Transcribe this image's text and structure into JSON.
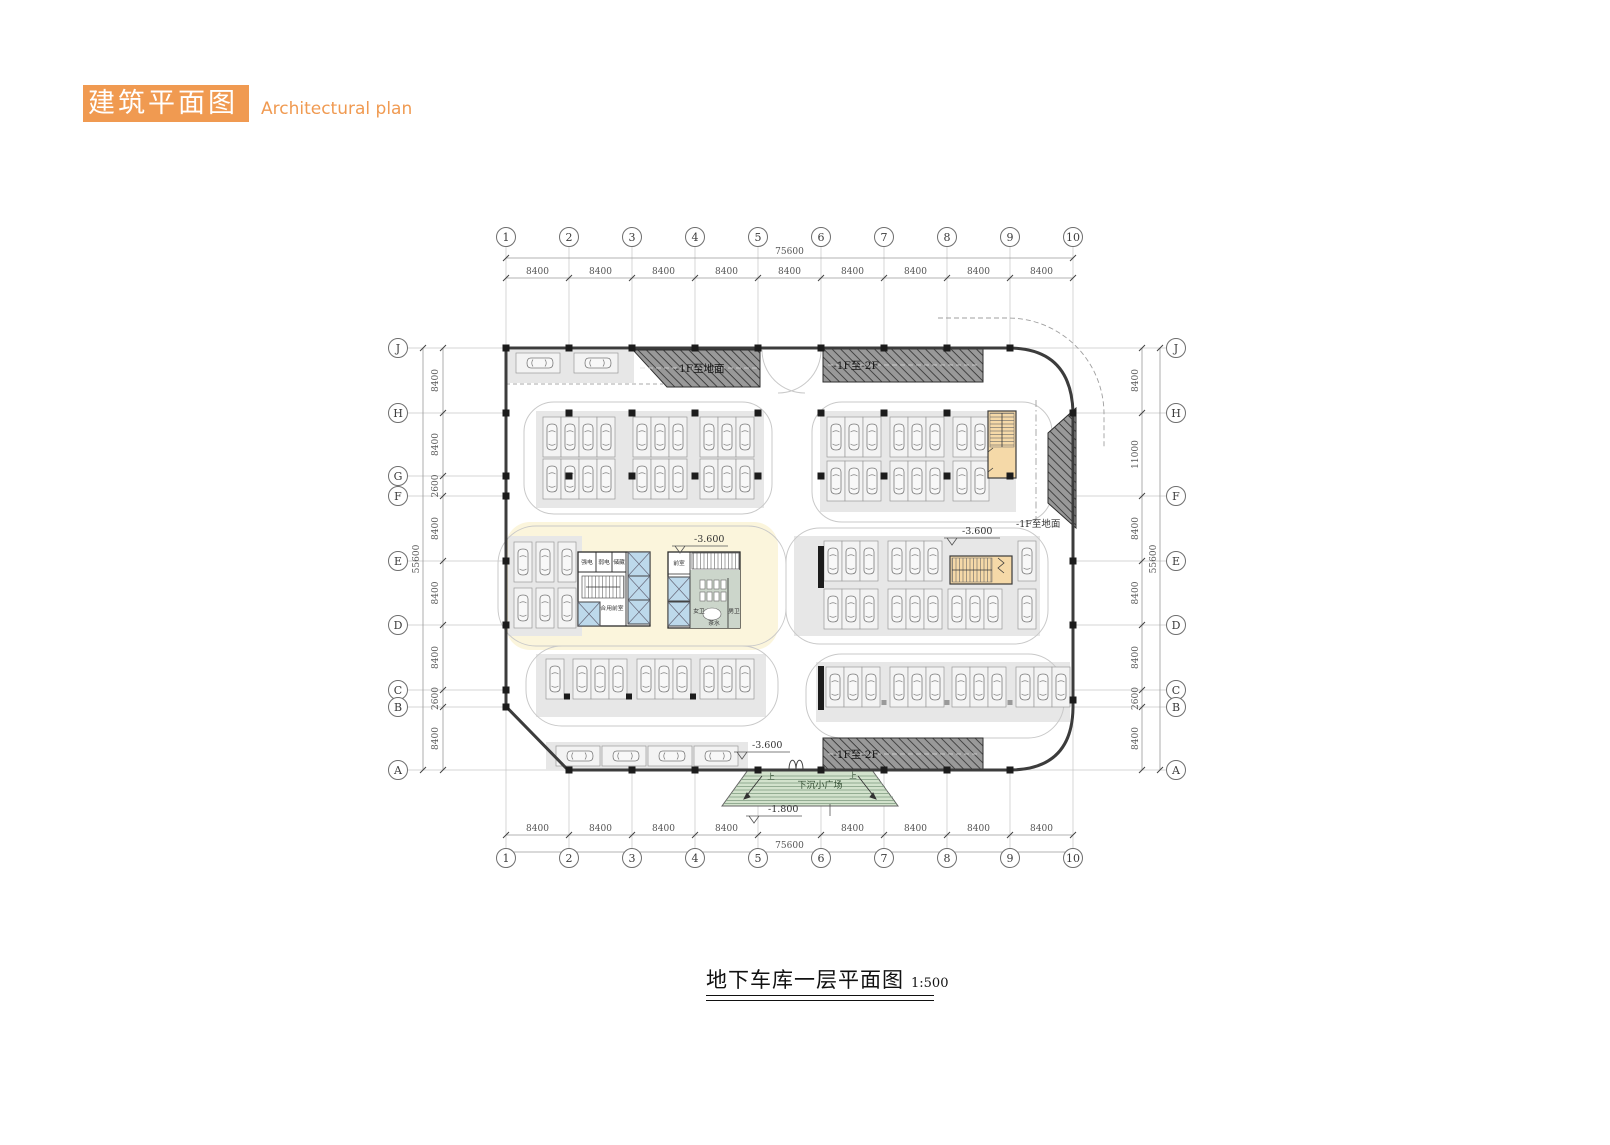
{
  "header": {
    "title_zh": "建筑平面图",
    "title_en": "Architectural plan"
  },
  "caption": {
    "title": "地下车库一层平面图",
    "scale": "1:500"
  },
  "plan": {
    "grid": {
      "top": [
        "1",
        "2",
        "3",
        "4",
        "5",
        "6",
        "7",
        "8",
        "9",
        "10"
      ],
      "bottom": [
        "1",
        "2",
        "3",
        "4",
        "5",
        "6",
        "7",
        "8",
        "9",
        "10"
      ],
      "left": [
        "J",
        "H",
        "G",
        "F",
        "E",
        "D",
        "C",
        "B",
        "A"
      ],
      "right": [
        "J",
        "H",
        "F",
        "E",
        "D",
        "C",
        "B",
        "A"
      ]
    },
    "dims": {
      "top": {
        "total": "75600",
        "segments": [
          "8400",
          "8400",
          "8400",
          "8400",
          "8400",
          "8400",
          "8400",
          "8400",
          "8400"
        ]
      },
      "bottom": {
        "total": "75600",
        "segments": [
          "8400",
          "8400",
          "8400",
          "8400",
          "8400",
          "8400",
          "8400",
          "8400"
        ]
      },
      "left": {
        "total": "55600",
        "segments": [
          "8400",
          "8400",
          "2600",
          "8400",
          "8400",
          "8400",
          "2600",
          "8400"
        ]
      },
      "right": {
        "total": "55600",
        "segments": [
          "8400",
          "11000",
          "8400",
          "8400",
          "8400",
          "2600",
          "8400"
        ]
      }
    },
    "labels": {
      "ramp_to_ground": "-1F至地面",
      "ramp_b1_b2": "-1F至-2F",
      "level_b1": "-3.600",
      "level_plaza": "-1.800",
      "plaza": "下沉小广场",
      "up": "上"
    },
    "rooms": {
      "strong_power": "强电",
      "weak_power": "弱电",
      "storage": "储藏",
      "shared_lobby": "合用前室",
      "lobby": "前室",
      "female_wc": "女卫",
      "male_wc": "男卫",
      "pantry": "茶水"
    },
    "colors": {
      "accent_orange": "#F09A51",
      "ramp_fill": "#9B9B9B",
      "stair_fill": "#F5D9A8",
      "elevator_fill": "#BDD9EB",
      "plaza_fill": "#D2E2CC",
      "island_fill": "#E7E7E7",
      "core_bg": "#FBF5DC"
    }
  }
}
